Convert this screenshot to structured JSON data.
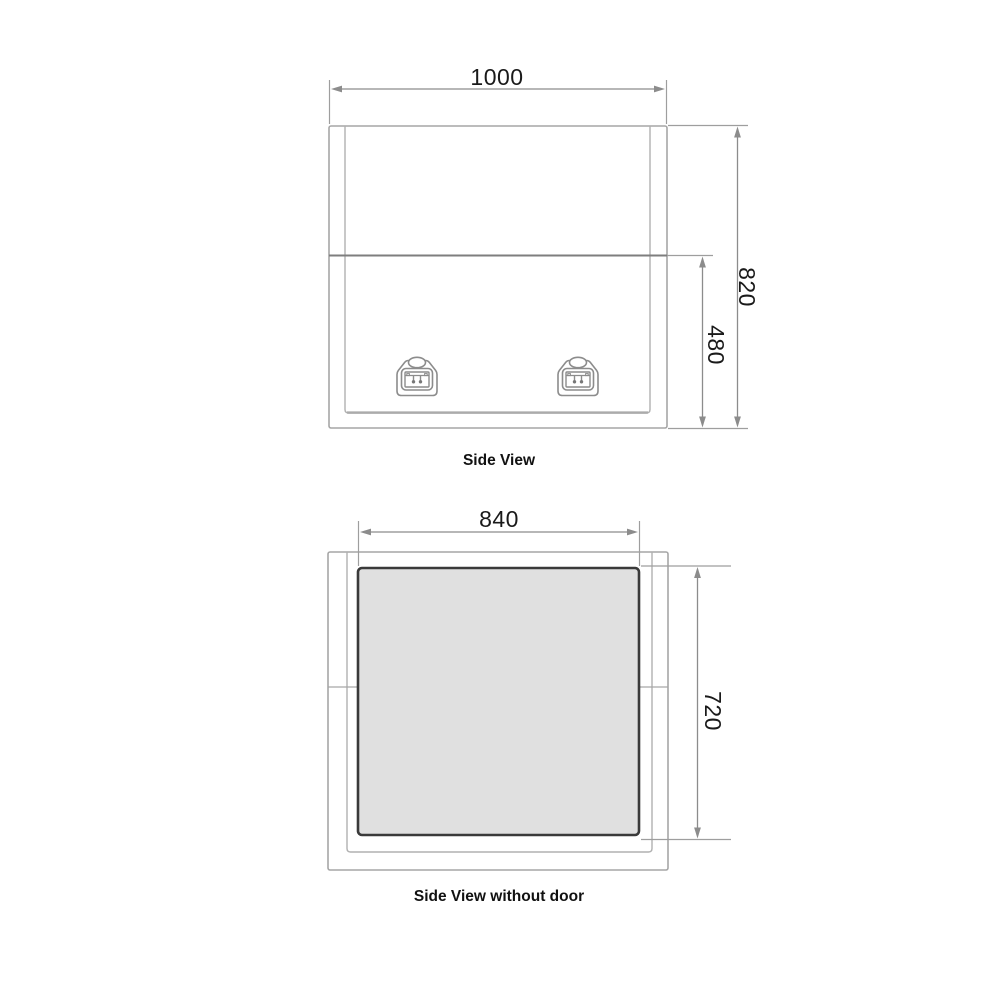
{
  "drawing": {
    "background": "#ffffff",
    "colors": {
      "outline": "#a6a6a6",
      "inner_outline": "#b0b0b0",
      "divider": "#7e7e7e",
      "dimension_line": "#8c8c8c",
      "extension_line": "#9e9e9e",
      "panel_fill": "#e0e0e0",
      "panel_border": "#3a3a3a",
      "text": "#1a1a1a"
    },
    "icons": {
      "latch": "paddle-latch-icon"
    },
    "side_view": {
      "caption": "Side View",
      "width": "1000",
      "total_height": "820",
      "door_height": "480",
      "latch_count": 2
    },
    "side_view_without_door": {
      "caption": "Side View without door",
      "opening_width": "840",
      "opening_height": "720"
    }
  }
}
